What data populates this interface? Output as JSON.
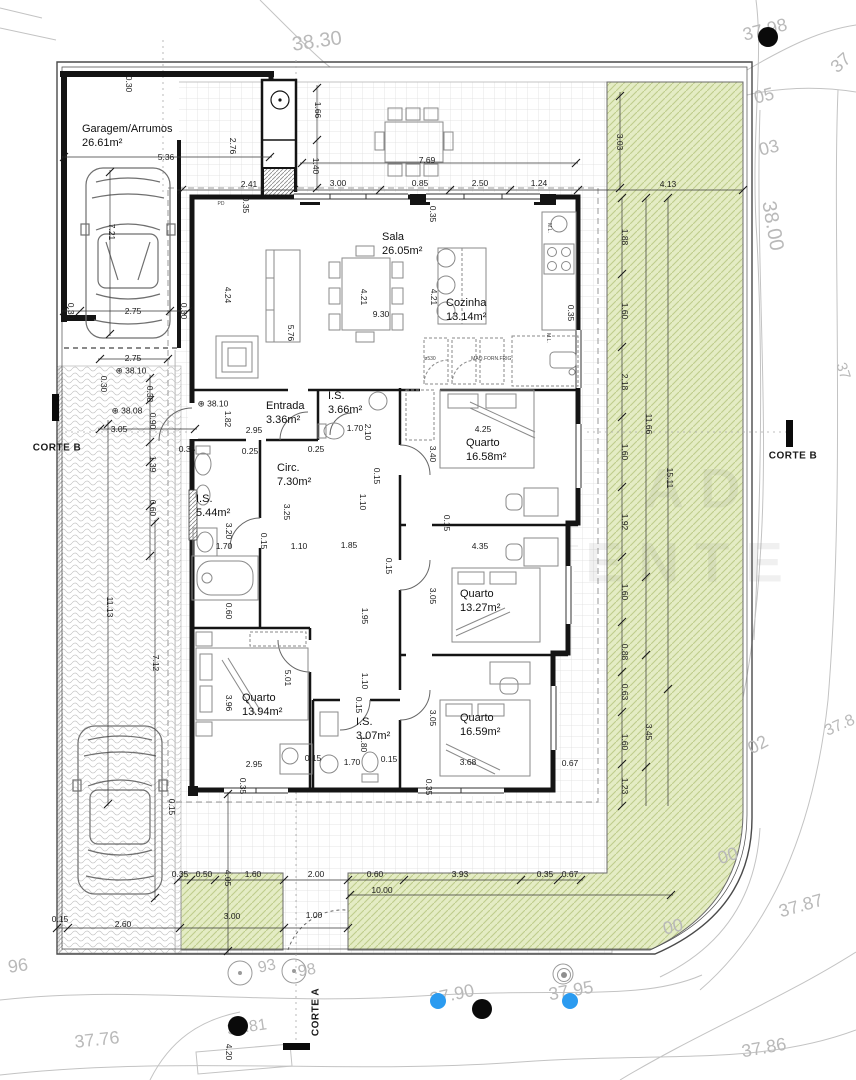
{
  "drawing": {
    "colors": {
      "green": "#e4ecc4",
      "green_hatch": "#bfcc8c",
      "wall": "#141414",
      "dim_text": "#1a1a1a",
      "contour_text": "#b9b9b9",
      "blue_dot": "#2b9bf0",
      "black_dot": "#0a0a0a",
      "gray_dot": "#8f8f8f"
    },
    "rooms": [
      {
        "name": "Garagem/Arrumos",
        "area": "26.61m²",
        "x": 82,
        "y": 122
      },
      {
        "name": "Sala",
        "area": "26.05m²",
        "x": 382,
        "y": 230
      },
      {
        "name": "Cozinha",
        "area": "13.14m²",
        "x": 446,
        "y": 296
      },
      {
        "name": "Entrada",
        "area": "3.36m²",
        "x": 266,
        "y": 399
      },
      {
        "name": "I.S.",
        "area": "3.66m²",
        "x": 328,
        "y": 389
      },
      {
        "name": "Quarto",
        "area": "16.58m²",
        "x": 466,
        "y": 436
      },
      {
        "name": "Circ.",
        "area": "7.30m²",
        "x": 277,
        "y": 461
      },
      {
        "name": "I.S.",
        "area": "5.44m²",
        "x": 196,
        "y": 492
      },
      {
        "name": "Quarto",
        "area": "13.27m²",
        "x": 460,
        "y": 587
      },
      {
        "name": "Quarto",
        "area": "13.94m²",
        "x": 242,
        "y": 691
      },
      {
        "name": "I.S.",
        "area": "3.07m²",
        "x": 356,
        "y": 715
      },
      {
        "name": "Quarto",
        "area": "16.59m²",
        "x": 460,
        "y": 711
      }
    ],
    "dims": [
      {
        "t": "0.30",
        "x": 129,
        "y": 84,
        "r": 90
      },
      {
        "t": "1.66",
        "x": 318,
        "y": 110,
        "r": 90
      },
      {
        "t": "5.36",
        "x": 166,
        "y": 157
      },
      {
        "t": "2.76",
        "x": 233,
        "y": 146,
        "r": 90
      },
      {
        "t": "7.69",
        "x": 427,
        "y": 160
      },
      {
        "t": "1.40",
        "x": 316,
        "y": 166,
        "r": 90
      },
      {
        "t": "2.41",
        "x": 249,
        "y": 184
      },
      {
        "t": "3.00",
        "x": 338,
        "y": 183
      },
      {
        "t": "0.85",
        "x": 420,
        "y": 183
      },
      {
        "t": "2.50",
        "x": 480,
        "y": 183
      },
      {
        "t": "1.24",
        "x": 539,
        "y": 183
      },
      {
        "t": "4.13",
        "x": 668,
        "y": 184
      },
      {
        "t": "3.03",
        "x": 620,
        "y": 142,
        "r": 90
      },
      {
        "t": "0.35",
        "x": 246,
        "y": 205,
        "r": 90
      },
      {
        "t": "0.35",
        "x": 433,
        "y": 214,
        "r": 90
      },
      {
        "t": "1.88",
        "x": 625,
        "y": 237,
        "r": 90
      },
      {
        "t": "7.21",
        "x": 112,
        "y": 232,
        "r": 90
      },
      {
        "t": "2.75",
        "x": 133,
        "y": 311
      },
      {
        "t": "0.30",
        "x": 71,
        "y": 311,
        "r": 90
      },
      {
        "t": "0.30",
        "x": 184,
        "y": 311,
        "r": 90
      },
      {
        "t": "4.24",
        "x": 228,
        "y": 295,
        "r": 90
      },
      {
        "t": "5.76",
        "x": 291,
        "y": 333,
        "r": 90
      },
      {
        "t": "4.21",
        "x": 364,
        "y": 297,
        "r": 90
      },
      {
        "t": "9.30",
        "x": 381,
        "y": 314
      },
      {
        "t": "4.21",
        "x": 434,
        "y": 297,
        "r": 90
      },
      {
        "t": "0.35",
        "x": 571,
        "y": 313,
        "r": 90
      },
      {
        "t": "1.60",
        "x": 625,
        "y": 311,
        "r": 90
      },
      {
        "t": "0.30",
        "x": 104,
        "y": 384,
        "r": 90
      },
      {
        "t": "2.75",
        "x": 133,
        "y": 358
      },
      {
        "t": "0.38",
        "x": 150,
        "y": 394,
        "r": 90
      },
      {
        "t": "0.90",
        "x": 153,
        "y": 421,
        "r": 90
      },
      {
        "t": "3.05",
        "x": 119,
        "y": 429
      },
      {
        "t": "2.18",
        "x": 625,
        "y": 382,
        "r": 90
      },
      {
        "t": "0.35",
        "x": 187,
        "y": 449
      },
      {
        "t": "1.82",
        "x": 228,
        "y": 419,
        "r": 90
      },
      {
        "t": "2.95",
        "x": 254,
        "y": 430
      },
      {
        "t": "1.70",
        "x": 355,
        "y": 428
      },
      {
        "t": "2.10",
        "x": 368,
        "y": 432,
        "r": 90
      },
      {
        "t": "0.25",
        "x": 250,
        "y": 451
      },
      {
        "t": "0.25",
        "x": 316,
        "y": 449
      },
      {
        "t": "4.25",
        "x": 483,
        "y": 429
      },
      {
        "t": "3.40",
        "x": 433,
        "y": 454,
        "r": 90
      },
      {
        "t": "11.66",
        "x": 649,
        "y": 424,
        "r": 90
      },
      {
        "t": "1.60",
        "x": 625,
        "y": 452,
        "r": 90
      },
      {
        "t": "0.15",
        "x": 377,
        "y": 476,
        "r": 90
      },
      {
        "t": "15.11",
        "x": 670,
        "y": 478,
        "r": 90
      },
      {
        "t": "1.10",
        "x": 363,
        "y": 502,
        "r": 90
      },
      {
        "t": "1.39",
        "x": 153,
        "y": 464,
        "r": 90
      },
      {
        "t": "3.25",
        "x": 287,
        "y": 512,
        "r": 90
      },
      {
        "t": "1.92",
        "x": 625,
        "y": 522,
        "r": 90
      },
      {
        "t": "0.15",
        "x": 447,
        "y": 523,
        "r": 90
      },
      {
        "t": "0.15",
        "x": 264,
        "y": 541,
        "r": 90
      },
      {
        "t": "3.20",
        "x": 229,
        "y": 531,
        "r": 90
      },
      {
        "t": "1.70",
        "x": 224,
        "y": 546
      },
      {
        "t": "1.10",
        "x": 299,
        "y": 546
      },
      {
        "t": "1.85",
        "x": 349,
        "y": 545
      },
      {
        "t": "4.35",
        "x": 480,
        "y": 546
      },
      {
        "t": "0.15",
        "x": 389,
        "y": 566,
        "r": 90
      },
      {
        "t": "1.60",
        "x": 625,
        "y": 592,
        "r": 90
      },
      {
        "t": "3.05",
        "x": 433,
        "y": 596,
        "r": 90
      },
      {
        "t": "0.60",
        "x": 153,
        "y": 508,
        "r": 90
      },
      {
        "t": "0.60",
        "x": 229,
        "y": 611,
        "r": 90
      },
      {
        "t": "1.95",
        "x": 365,
        "y": 616,
        "r": 90
      },
      {
        "t": "0.88",
        "x": 625,
        "y": 652,
        "r": 90
      },
      {
        "t": "5.01",
        "x": 288,
        "y": 678,
        "r": 90
      },
      {
        "t": "1.10",
        "x": 365,
        "y": 681,
        "r": 90
      },
      {
        "t": "0.63",
        "x": 625,
        "y": 692,
        "r": 90
      },
      {
        "t": "3.96",
        "x": 229,
        "y": 703,
        "r": 90
      },
      {
        "t": "0.15",
        "x": 359,
        "y": 705,
        "r": 90
      },
      {
        "t": "3.05",
        "x": 433,
        "y": 718,
        "r": 90
      },
      {
        "t": "1.60",
        "x": 625,
        "y": 742,
        "r": 90
      },
      {
        "t": "3.45",
        "x": 649,
        "y": 732,
        "r": 90
      },
      {
        "t": "11.13",
        "x": 110,
        "y": 607,
        "r": 90
      },
      {
        "t": "7.12",
        "x": 156,
        "y": 663,
        "r": 90
      },
      {
        "t": "2.95",
        "x": 254,
        "y": 764
      },
      {
        "t": "1.70",
        "x": 352,
        "y": 762
      },
      {
        "t": "1.80",
        "x": 364,
        "y": 744,
        "r": 90
      },
      {
        "t": "0.15",
        "x": 313,
        "y": 758
      },
      {
        "t": "0.15",
        "x": 389,
        "y": 759
      },
      {
        "t": "3.68",
        "x": 468,
        "y": 762
      },
      {
        "t": "0.67",
        "x": 570,
        "y": 763
      },
      {
        "t": "1.23",
        "x": 625,
        "y": 786,
        "r": 90
      },
      {
        "t": "0.35",
        "x": 243,
        "y": 786,
        "r": 90
      },
      {
        "t": "0.35",
        "x": 429,
        "y": 787,
        "r": 90
      },
      {
        "t": "0.15",
        "x": 172,
        "y": 807,
        "r": 90
      },
      {
        "t": "0.35",
        "x": 180,
        "y": 874
      },
      {
        "t": "0.50",
        "x": 204,
        "y": 874
      },
      {
        "t": "1.60",
        "x": 253,
        "y": 874
      },
      {
        "t": "2.00",
        "x": 316,
        "y": 874
      },
      {
        "t": "0.60",
        "x": 375,
        "y": 874
      },
      {
        "t": "3.93",
        "x": 460,
        "y": 874
      },
      {
        "t": "0.35",
        "x": 545,
        "y": 874
      },
      {
        "t": "0.67",
        "x": 570,
        "y": 874
      },
      {
        "t": "4.05",
        "x": 228,
        "y": 878,
        "r": 90
      },
      {
        "t": "10.00",
        "x": 382,
        "y": 890
      },
      {
        "t": "3.00",
        "x": 232,
        "y": 916
      },
      {
        "t": "1.00",
        "x": 314,
        "y": 915
      },
      {
        "t": "0.15",
        "x": 60,
        "y": 919
      },
      {
        "t": "2.60",
        "x": 123,
        "y": 924
      },
      {
        "t": "4.20",
        "x": 229,
        "y": 1052,
        "r": 90
      }
    ],
    "levels": [
      {
        "t": "38.10",
        "x": 131,
        "y": 371
      },
      {
        "t": "38.08",
        "x": 127,
        "y": 411
      },
      {
        "t": "38.10",
        "x": 213,
        "y": 404
      }
    ],
    "contours": [
      {
        "t": "38.30",
        "x": 317,
        "y": 42,
        "r": -8,
        "s": 20
      },
      {
        "t": "37.98",
        "x": 765,
        "y": 30,
        "r": -14,
        "s": 18
      },
      {
        "t": "37",
        "x": 841,
        "y": 63,
        "r": -42,
        "s": 18
      },
      {
        "t": "05",
        "x": 764,
        "y": 96,
        "r": -14,
        "s": 18
      },
      {
        "t": "03",
        "x": 769,
        "y": 148,
        "r": -14,
        "s": 18
      },
      {
        "t": "38.00",
        "x": 772,
        "y": 226,
        "r": 80,
        "s": 20
      },
      {
        "t": "37",
        "x": 843,
        "y": 371,
        "r": 72,
        "s": 15
      },
      {
        "t": "02",
        "x": 758,
        "y": 745,
        "r": -28,
        "s": 18
      },
      {
        "t": "37.8",
        "x": 840,
        "y": 726,
        "r": -24,
        "s": 16
      },
      {
        "t": "00",
        "x": 728,
        "y": 856,
        "r": -18,
        "s": 18
      },
      {
        "t": "37.87",
        "x": 801,
        "y": 906,
        "r": -16,
        "s": 18
      },
      {
        "t": "00",
        "x": 673,
        "y": 927,
        "r": -14,
        "s": 18
      },
      {
        "t": "96",
        "x": 18,
        "y": 966,
        "r": -8,
        "s": 18
      },
      {
        "t": "93",
        "x": 267,
        "y": 967,
        "r": -12,
        "s": 16
      },
      {
        "t": "98",
        "x": 307,
        "y": 971,
        "r": -10,
        "s": 16
      },
      {
        "t": "37.90",
        "x": 452,
        "y": 995,
        "r": -12,
        "s": 18
      },
      {
        "t": "37.95",
        "x": 571,
        "y": 991,
        "r": -10,
        "s": 18
      },
      {
        "t": "37.81",
        "x": 247,
        "y": 1028,
        "r": -8,
        "s": 16
      },
      {
        "t": "37.76",
        "x": 97,
        "y": 1040,
        "r": -6,
        "s": 18
      },
      {
        "t": "37.86",
        "x": 764,
        "y": 1048,
        "r": -10,
        "s": 18
      }
    ],
    "tiny": [
      {
        "t": "ø530",
        "x": 430,
        "y": 359
      },
      {
        "t": "MAQ.FORN.FRIG.",
        "x": 492,
        "y": 359
      },
      {
        "t": "M.L.",
        "x": 549,
        "y": 228,
        "r": 90
      },
      {
        "t": "M.L.",
        "x": 548,
        "y": 338,
        "r": 90
      },
      {
        "t": "PD",
        "x": 221,
        "y": 204
      }
    ],
    "sections": [
      {
        "t": "CORTE B",
        "x": 57,
        "y": 448
      },
      {
        "t": "CORTE B",
        "x": 793,
        "y": 456
      },
      {
        "t": "CORTE A",
        "x": 316,
        "y": 1012,
        "r": -90
      }
    ],
    "watermark": [
      {
        "t": "AD",
        "x": 700,
        "y": 488
      },
      {
        "t": "ENTE",
        "x": 692,
        "y": 562
      }
    ],
    "dots": [
      {
        "c": "black",
        "x": 768,
        "y": 37,
        "r": 10
      },
      {
        "c": "black",
        "x": 238,
        "y": 1026,
        "r": 10
      },
      {
        "c": "black",
        "x": 482,
        "y": 1009,
        "r": 10
      },
      {
        "c": "blue",
        "x": 438,
        "y": 1001,
        "r": 8
      },
      {
        "c": "blue",
        "x": 570,
        "y": 1001,
        "r": 8
      },
      {
        "c": "gray",
        "x": 563,
        "y": 974,
        "r": 6
      }
    ]
  }
}
